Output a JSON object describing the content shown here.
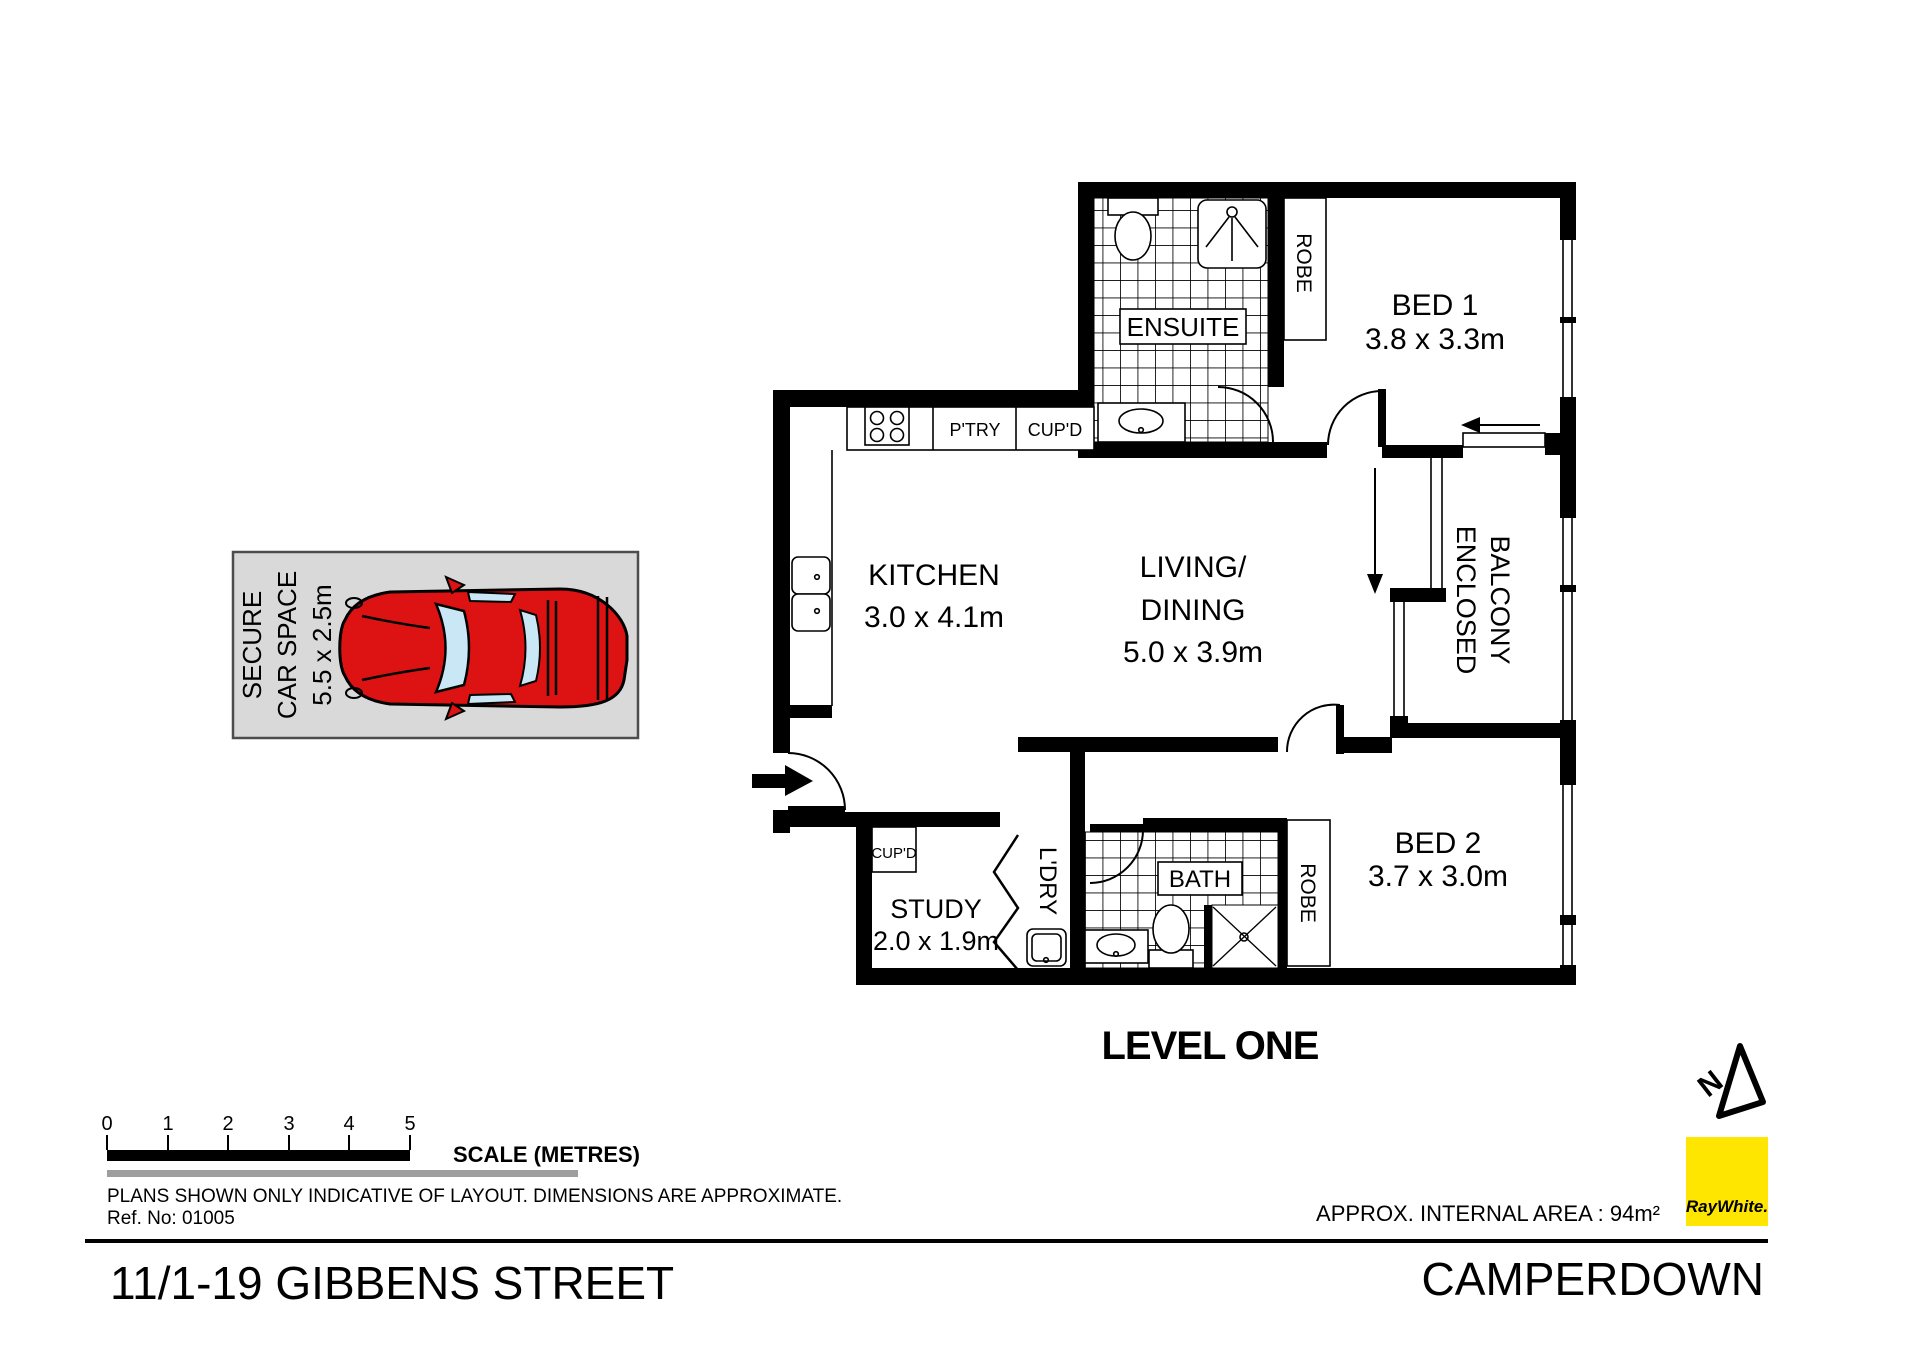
{
  "plan": {
    "level_label": "LEVEL ONE",
    "rooms": {
      "kitchen": {
        "name": "KITCHEN",
        "dims": "3.0 x 4.1m"
      },
      "living": {
        "name_line1": "LIVING/",
        "name_line2": "DINING",
        "dims": "5.0 x 3.9m"
      },
      "bed1": {
        "name": "BED 1",
        "dims": "3.8 x 3.3m"
      },
      "bed2": {
        "name": "BED 2",
        "dims": "3.7 x 3.0m"
      },
      "ensuite": {
        "name": "ENSUITE"
      },
      "bath": {
        "name": "BATH"
      },
      "study": {
        "name": "STUDY",
        "dims": "2.0 x 1.9m"
      },
      "laundry": {
        "name": "L'DRY"
      },
      "balcony": {
        "name_line1": "ENCLOSED",
        "name_line2": "BALCONY"
      },
      "robe1": {
        "name": "ROBE"
      },
      "robe2": {
        "name": "ROBE"
      },
      "pantry": {
        "name": "P'TRY"
      },
      "cupboard_kitchen": {
        "name": "CUP'D"
      },
      "cupboard_study": {
        "name": "CUP'D"
      }
    },
    "car_space": {
      "line1": "SECURE",
      "line2": "CAR SPACE",
      "line3": "5.5 x 2.5m"
    }
  },
  "scale_bar": {
    "ticks": [
      "0",
      "1",
      "2",
      "3",
      "4",
      "5"
    ],
    "label": "SCALE (METRES)"
  },
  "notes": {
    "disclaimer": "PLANS SHOWN ONLY INDICATIVE OF LAYOUT.  DIMENSIONS ARE APPROXIMATE.",
    "ref_no": "Ref. No: 01005"
  },
  "footer": {
    "address": "11/1-19 GIBBENS STREET",
    "suburb": "CAMPERDOWN",
    "internal_area": "APPROX. INTERNAL AREA : 94m²",
    "brand": "RayWhite."
  },
  "colors": {
    "wall_black": "#000000",
    "brand_yellow": "#ffe600",
    "brand_text": "#4a4a4a",
    "car_red": "#dd1212",
    "glass_blue": "#c9e7f4",
    "car_space_gray": "#d9d9d9",
    "underline_gray": "#9e9e9e"
  }
}
